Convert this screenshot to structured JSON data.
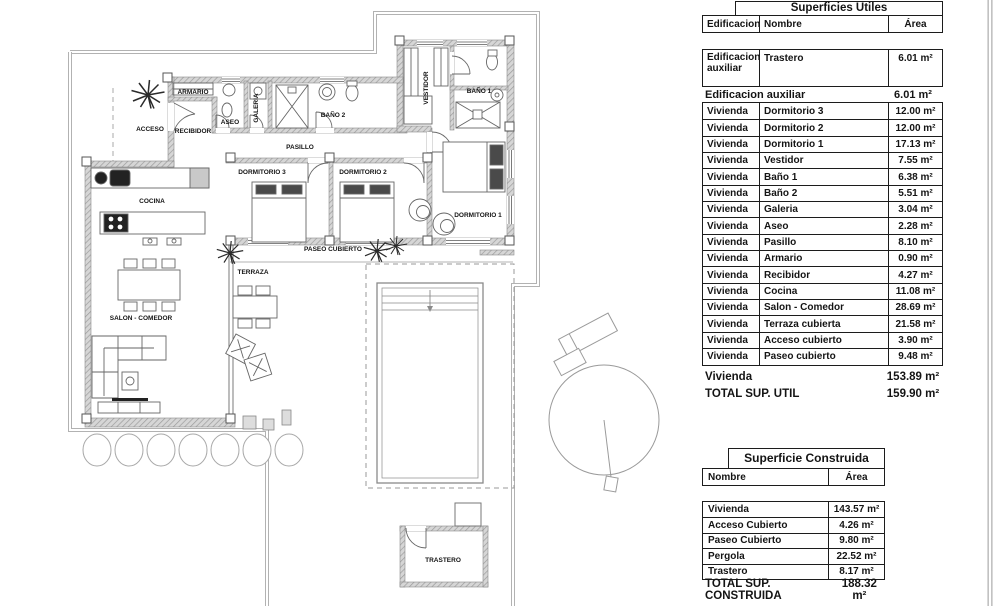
{
  "floor_plan": {
    "rooms": {
      "acceso": "ACCESO",
      "armario": "ARMARIO",
      "recibidor": "RECIBIDOR",
      "aseo": "ASEO",
      "galeria": "GALERIA",
      "bano_2": "BAÑO 2",
      "pasillo": "PASILLO",
      "dormitorio_3": "DORMITORIO 3",
      "dormitorio_2": "DORMITORIO 2",
      "dormitorio_1": "DORMITORIO 1",
      "vestidor": "VESTIDOR",
      "bano_1": "BAÑO 1",
      "cocina": "COCINA",
      "salon_comedor": "SALON - COMEDOR",
      "terraza": "TERRAZA",
      "paseo_cubierto": "PASEO CUBIERTO",
      "trastero": "TRASTERO"
    }
  },
  "tables": {
    "superficies_utiles": {
      "title": "Superficies Utiles",
      "columns": [
        "Edificacion",
        "Nombre",
        "Área"
      ],
      "aux_group": {
        "edificacion": "Edificacion auxiliar",
        "rows": [
          [
            "Trastero",
            "6.01 m²"
          ]
        ],
        "subtotal_label": "Edificacion auxiliar",
        "subtotal_value": "6.01 m²"
      },
      "vivienda_rows": [
        [
          "Vivienda",
          "Dormitorio 3",
          "12.00 m²"
        ],
        [
          "Vivienda",
          "Dormitorio 2",
          "12.00 m²"
        ],
        [
          "Vivienda",
          "Dormitorio 1",
          "17.13 m²"
        ],
        [
          "Vivienda",
          "Vestidor",
          "7.55 m²"
        ],
        [
          "Vivienda",
          "Baño 1",
          "6.38 m²"
        ],
        [
          "Vivienda",
          "Baño 2",
          "5.51 m²"
        ],
        [
          "Vivienda",
          "Galeria",
          "3.04 m²"
        ],
        [
          "Vivienda",
          "Aseo",
          "2.28 m²"
        ],
        [
          "Vivienda",
          "Pasillo",
          "8.10 m²"
        ],
        [
          "Vivienda",
          "Armario",
          "0.90 m²"
        ],
        [
          "Vivienda",
          "Recibidor",
          "4.27 m²"
        ],
        [
          "Vivienda",
          "Cocina",
          "11.08 m²"
        ],
        [
          "Vivienda",
          "Salon - Comedor",
          "28.69 m²"
        ],
        [
          "Vivienda",
          "Terraza cubierta",
          "21.58 m²"
        ],
        [
          "Vivienda",
          "Acceso cubierto",
          "3.90 m²"
        ],
        [
          "Vivienda",
          "Paseo cubierto",
          "9.48 m²"
        ]
      ],
      "vivienda_subtotal_label": "Vivienda",
      "vivienda_subtotal_value": "153.89 m²",
      "total_label": "TOTAL SUP. UTIL",
      "total_value": "159.90 m²"
    },
    "superficie_construida": {
      "title": "Superficie Construida",
      "columns": [
        "Nombre",
        "Área"
      ],
      "rows": [
        [
          "Vivienda",
          "143.57 m²"
        ],
        [
          "Acceso Cubierto",
          "4.26 m²"
        ],
        [
          "Paseo Cubierto",
          "9.80 m²"
        ],
        [
          "Pergola",
          "22.52 m²"
        ],
        [
          "Trastero",
          "8.17 m²"
        ]
      ],
      "total_label": "TOTAL SUP. CONSTRUIDA",
      "total_value": "188.32 m²"
    }
  }
}
